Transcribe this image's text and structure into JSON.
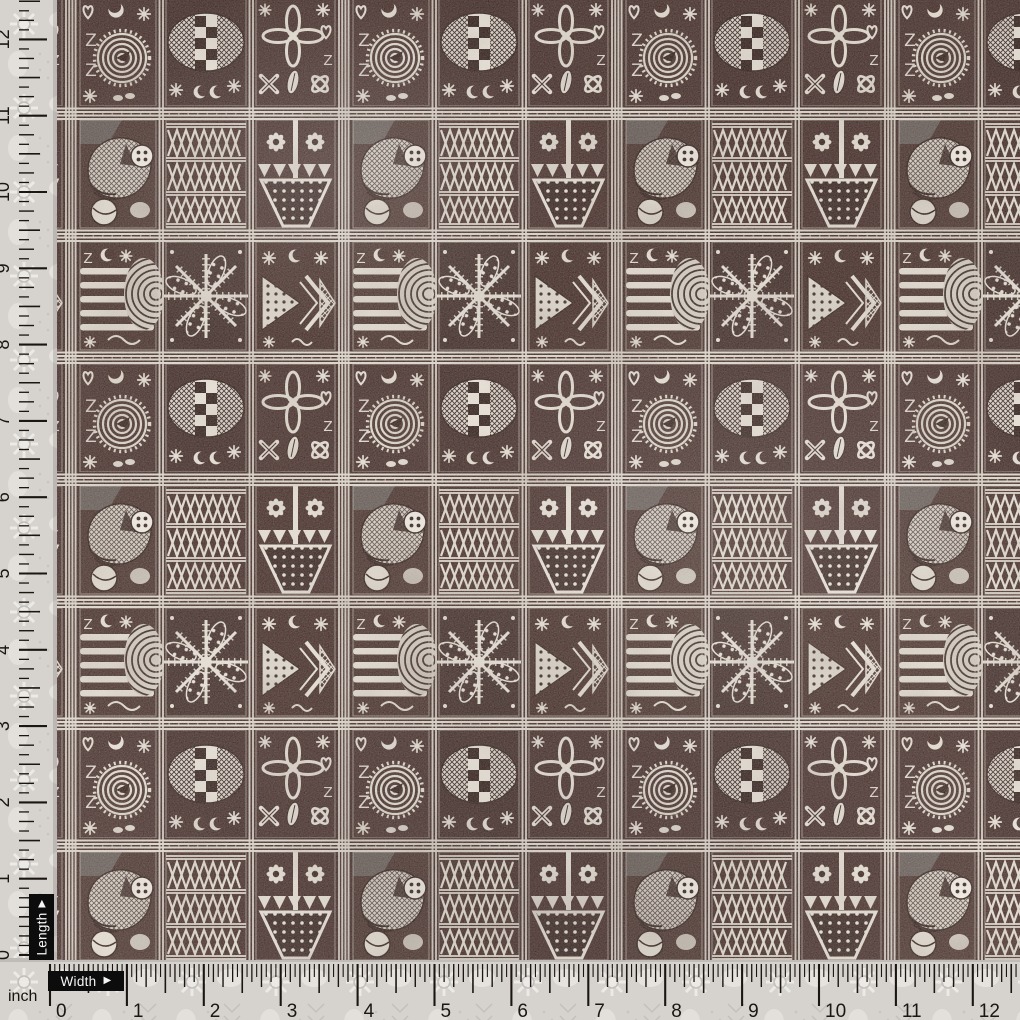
{
  "photo": {
    "subject": "Dark maroon tribal block-print fabric swatch measured with inch rulers"
  },
  "labels": {
    "length": "Length",
    "width": "Width",
    "unit": "inch",
    "arrow": "▶"
  },
  "rulers": {
    "unit": "inch",
    "bottom": {
      "label": "Width",
      "zero_px": 50,
      "inch_px": 76.9,
      "subdivisions_per_inch": 16,
      "numbers": [
        "0",
        "1",
        "2",
        "3",
        "4",
        "5",
        "6",
        "7",
        "8",
        "9",
        "10",
        "11",
        "12"
      ]
    },
    "left": {
      "label": "Length",
      "zero_px": 955,
      "inch_px": 76.3,
      "subdivisions_per_inch": 8,
      "numbers": [
        "0",
        "1",
        "2",
        "3",
        "4",
        "5",
        "6",
        "7",
        "8",
        "9",
        "10",
        "11",
        "12"
      ]
    }
  },
  "fabric": {
    "style": "hand block print grid (tapa / adinkra style)",
    "colors": {
      "ground": "#371f1b",
      "ground_alt": "#402823",
      "ink": "#e3dcd1",
      "ink_dim": "#cfc8bd",
      "outline_dark": "#27140f",
      "selvage": "#d6d2ce",
      "tick": "#1b1612",
      "label_bg": "#0c0c0c",
      "label_text": "#f6f5f3"
    },
    "motifs": [
      "spiral",
      "checkerboard-oval",
      "quatrefoil-flower",
      "fish",
      "triangle-lattice",
      "daisy-pair",
      "dotted-vase",
      "stripe-shell",
      "starburst",
      "dotted-chevron-arrow",
      "eight-point-stars",
      "crescent-moons",
      "Z-glyphs",
      "hearts"
    ]
  }
}
